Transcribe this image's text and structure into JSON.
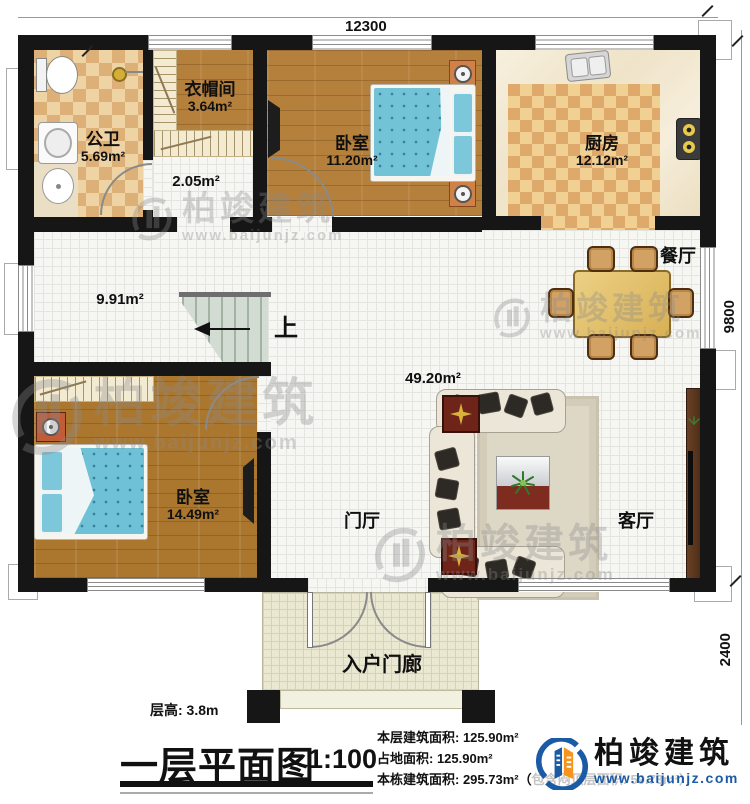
{
  "meta": {
    "title": "一层平面图",
    "scale": "1:100",
    "floor_height": "层高: 3.8m"
  },
  "dimensions": {
    "top": "12300",
    "right_upper": "9800",
    "right_lower": "2400"
  },
  "rooms": {
    "bathroom": {
      "name": "公卫",
      "area": "5.69m²"
    },
    "cloakroom": {
      "name": "衣帽间",
      "area": "3.64m²"
    },
    "hallway": {
      "area": "2.05m²"
    },
    "bedroom1": {
      "name": "卧室",
      "area": "11.20m²"
    },
    "kitchen": {
      "name": "厨房",
      "area": "12.12m²"
    },
    "corridor": {
      "area": "9.91m²"
    },
    "dining": {
      "name": "餐厅"
    },
    "open_area": {
      "area": "49.20m²"
    },
    "bedroom2": {
      "name": "卧室",
      "area": "14.49m²"
    },
    "foyer": {
      "name": "门厅"
    },
    "living": {
      "name": "客厅"
    },
    "porch": {
      "name": "入户门廊"
    }
  },
  "stairs": {
    "direction_label": "上"
  },
  "stats": {
    "line1": "本层建筑面积: 125.90m²",
    "line2": "占地面积: 125.90m²",
    "line3": "本栋建筑面积: 295.73m²（包含闷顶层面积: 59.73m²）"
  },
  "brand": {
    "name": "柏竣建筑",
    "url": "www.baijunjz.com"
  },
  "watermark": {
    "name": "柏竣建筑",
    "url": "www.baijunjz.com"
  },
  "colors": {
    "wall": "#161616",
    "brand_blue": "#1b5aa5",
    "brand_orange": "#f7941d"
  }
}
